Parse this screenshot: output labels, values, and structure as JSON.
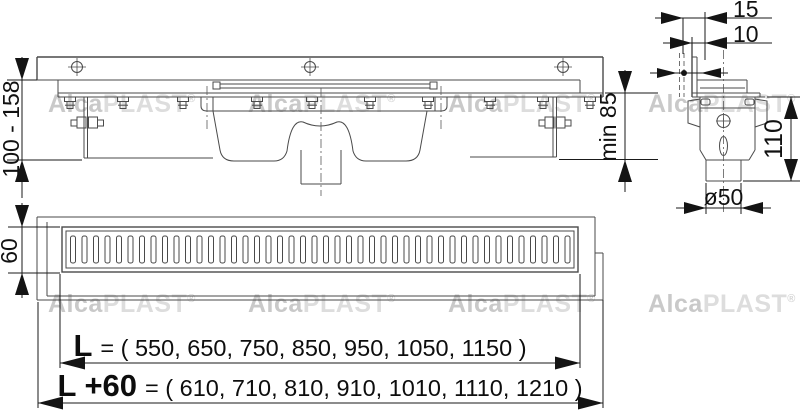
{
  "watermark": {
    "brand_bold": "Alca",
    "brand_light": "PLAST",
    "registered": "®"
  },
  "dimensions": {
    "installation_height": "100 - 158",
    "wall_gap_outer": "15",
    "wall_gap_inner": "10",
    "min_depth": "min 85",
    "trap_height": "110",
    "outlet_diameter": "ø50",
    "grate_width": "60"
  },
  "lengths": {
    "l_label": "L",
    "l_rest": "= ( 550, 650, 750, 850, 950, 1050, 1150 )",
    "l60_label": "L +60",
    "l60_rest": "= ( 610, 710, 810, 910, 1010, 1110, 1210 )"
  },
  "grate": {
    "slot_count": 44
  }
}
